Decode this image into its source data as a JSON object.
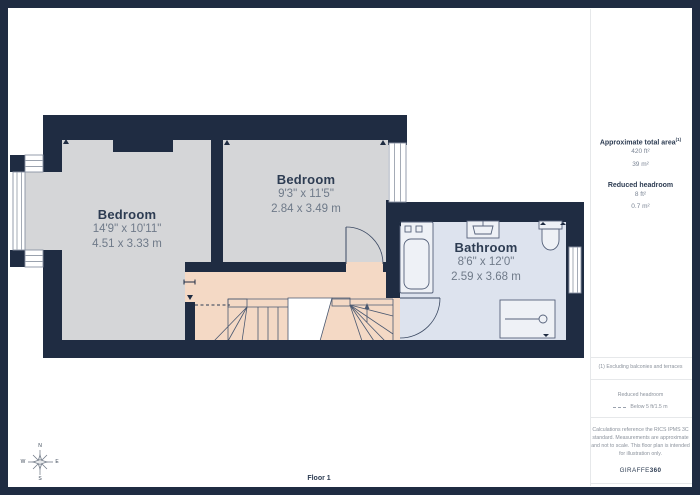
{
  "colors": {
    "wall": "#1f2c42",
    "bedroom_floor": "#d5d6d8",
    "hallway_floor": "#f4d9c5",
    "bathroom_floor": "#dde3ee",
    "fixture_fill": "#eef1f6",
    "canvas": "#ffffff",
    "text_primary": "#2d3c52",
    "text_secondary": "#6f7a89"
  },
  "plan": {
    "rooms": [
      {
        "name": "Bedroom",
        "dimensions_imperial": "14'9\" x 10'11\"",
        "dimensions_metric": "4.51 x 3.33 m"
      },
      {
        "name": "Bedroom",
        "dimensions_imperial": "9'3\" x 11'5\"",
        "dimensions_metric": "2.84 x 3.49 m"
      },
      {
        "name": "Bathroom",
        "dimensions_imperial": "8'6\" x 12'0\"",
        "dimensions_metric": "2.59 x 3.68 m"
      }
    ],
    "floor_label": "Floor 1",
    "compass": {
      "north": "N",
      "west": "W",
      "east": "E",
      "south": "S"
    }
  },
  "sidebar": {
    "total_area": {
      "heading": "Approximate total area",
      "superscript": "(1)",
      "value_imperial": "420 ft²",
      "value_metric": "39 m²"
    },
    "reduced_headroom": {
      "heading": "Reduced headroom",
      "value_imperial": "8 ft²",
      "value_metric": "0.7 m²"
    },
    "footnote": "(1) Excluding balconies and terraces",
    "legend": {
      "heading": "Reduced headroom",
      "item_label": "Below 5 ft/1.5 m"
    },
    "disclaimer": "Calculations reference the RICS IPMS 3C standard. Measurements are approximate and not to scale. This floor plan is intended for illustration only.",
    "brand": {
      "name": "GIRAFFE",
      "suffix": "360"
    }
  }
}
